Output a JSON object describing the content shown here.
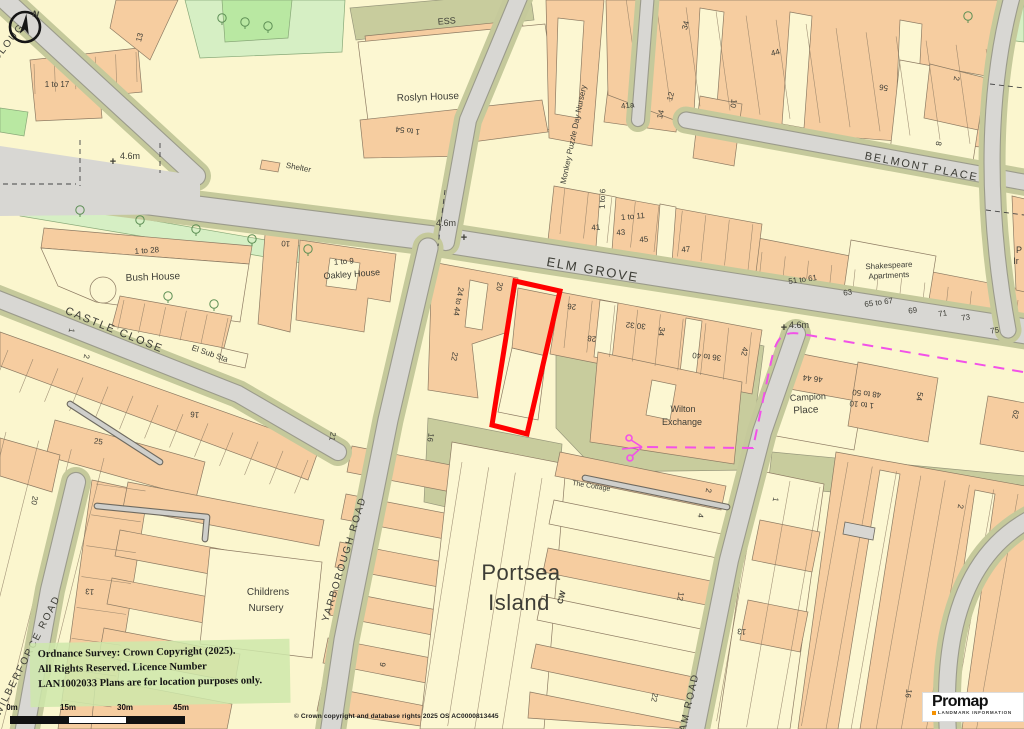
{
  "map": {
    "plot_color": "#FF0000",
    "boundary_color": "#F251E8",
    "labels": [
      {
        "t": "ELM GROVE",
        "x": 592,
        "y": 274,
        "r": 10,
        "s": 13,
        "k": "street"
      },
      {
        "t": "BELMONT PLACE",
        "x": 921,
        "y": 170,
        "r": 11,
        "s": 11,
        "k": "street"
      },
      {
        "t": "CASTLE CLOSE",
        "x": 113,
        "y": 333,
        "r": 22,
        "s": 11,
        "k": "street"
      },
      {
        "t": "YARBOROUGH ROAD",
        "x": 347,
        "y": 560,
        "r": -73,
        "s": 10,
        "k": "street"
      },
      {
        "t": "WILBERFORCE ROAD",
        "x": 30,
        "y": 657,
        "r": -63,
        "s": 10,
        "k": "street"
      },
      {
        "t": "AM ROAD",
        "x": 692,
        "y": 703,
        "r": -77,
        "s": 10,
        "k": "street"
      },
      {
        "t": "CLOUG",
        "x": 11,
        "y": 44,
        "r": -52,
        "s": 10,
        "k": "street"
      },
      {
        "t": "Roslyn House",
        "x": 428,
        "y": 100,
        "r": -2,
        "s": 10,
        "k": "name"
      },
      {
        "t": "ESS",
        "x": 447,
        "y": 24,
        "r": -5,
        "s": 9,
        "k": "name"
      },
      {
        "t": "Bush House",
        "x": 153,
        "y": 280,
        "r": -2,
        "s": 10,
        "k": "name"
      },
      {
        "t": "1 to 9",
        "x": 344,
        "y": 264,
        "r": -4,
        "s": 8,
        "k": "num"
      },
      {
        "t": "Oakley House",
        "x": 352,
        "y": 277,
        "r": -4,
        "s": 9,
        "k": "name"
      },
      {
        "t": "Shakespeare",
        "x": 889,
        "y": 268,
        "r": -3,
        "s": 8,
        "k": "name"
      },
      {
        "t": "Apartments",
        "x": 889,
        "y": 278,
        "r": -3,
        "s": 8,
        "k": "name"
      },
      {
        "t": "Wilton",
        "x": 683,
        "y": 412,
        "r": 0,
        "s": 9,
        "k": "name"
      },
      {
        "t": "Exchange",
        "x": 682,
        "y": 425,
        "r": 0,
        "s": 9,
        "k": "name"
      },
      {
        "t": "Campion",
        "x": 808,
        "y": 400,
        "r": -3,
        "s": 9,
        "k": "name"
      },
      {
        "t": "Place",
        "x": 806,
        "y": 413,
        "r": -3,
        "s": 10,
        "k": "name"
      },
      {
        "t": "Childrens",
        "x": 268,
        "y": 595,
        "r": 0,
        "s": 10,
        "k": "name"
      },
      {
        "t": "Nursery",
        "x": 266,
        "y": 611,
        "r": 0,
        "s": 10,
        "k": "name"
      },
      {
        "t": "The Cottage",
        "x": 591,
        "y": 488,
        "r": 9,
        "s": 7,
        "k": "name"
      },
      {
        "t": "Monkey Puzzle Day Nursery",
        "x": 576,
        "y": 135,
        "r": -78,
        "s": 8,
        "k": "name"
      },
      {
        "t": "Shelter",
        "x": 298,
        "y": 170,
        "r": 11,
        "s": 8,
        "k": "name"
      },
      {
        "t": "El Sub Sta",
        "x": 209,
        "y": 356,
        "r": 19,
        "s": 8,
        "k": "name"
      },
      {
        "t": "P",
        "x": 1019,
        "y": 253,
        "r": 0,
        "s": 9,
        "k": "name"
      },
      {
        "t": "Ir",
        "x": 1016,
        "y": 264,
        "r": 0,
        "s": 9,
        "k": "name"
      },
      {
        "t": "Portsea",
        "x": 521,
        "y": 580,
        "r": 0,
        "s": 22,
        "k": "big"
      },
      {
        "t": "Island",
        "x": 519,
        "y": 610,
        "r": 0,
        "s": 22,
        "k": "big"
      },
      {
        "t": "CW",
        "x": 564,
        "y": 598,
        "r": -75,
        "s": 8,
        "k": "mag"
      },
      {
        "t": "13",
        "x": 142,
        "y": 38,
        "r": -75,
        "s": 8,
        "k": "num"
      },
      {
        "t": "1 to 17",
        "x": 57,
        "y": 87,
        "r": 0,
        "s": 8,
        "k": "num"
      },
      {
        "t": "1 to 54",
        "x": 408,
        "y": 128,
        "r": 187,
        "s": 8,
        "k": "num"
      },
      {
        "t": "1 to 28",
        "x": 147,
        "y": 253,
        "r": -4,
        "s": 8,
        "k": "num"
      },
      {
        "t": "41a",
        "x": 628,
        "y": 108,
        "r": -8,
        "s": 8,
        "k": "num"
      },
      {
        "t": "14",
        "x": 663,
        "y": 115,
        "r": -75,
        "s": 8,
        "k": "num"
      },
      {
        "t": "12",
        "x": 673,
        "y": 97,
        "r": -75,
        "s": 8,
        "k": "num"
      },
      {
        "t": "34",
        "x": 688,
        "y": 26,
        "r": -75,
        "s": 8,
        "k": "num"
      },
      {
        "t": "44",
        "x": 776,
        "y": 55,
        "r": -15,
        "s": 8,
        "k": "num"
      },
      {
        "t": "10",
        "x": 731,
        "y": 103,
        "r": 100,
        "s": 8,
        "k": "num"
      },
      {
        "t": "56",
        "x": 884,
        "y": 85,
        "r": 188,
        "s": 8,
        "k": "num"
      },
      {
        "t": "2",
        "x": 954,
        "y": 78,
        "r": 100,
        "s": 8,
        "k": "num"
      },
      {
        "t": "8",
        "x": 936,
        "y": 143,
        "r": 100,
        "s": 8,
        "k": "num"
      },
      {
        "t": "10",
        "x": 286,
        "y": 241,
        "r": 185,
        "s": 8,
        "k": "num"
      },
      {
        "t": "1 to 6",
        "x": 605,
        "y": 199,
        "r": -88,
        "s": 8,
        "k": "num"
      },
      {
        "t": "41",
        "x": 596,
        "y": 230,
        "r": -5,
        "s": 8,
        "k": "num"
      },
      {
        "t": "1 to 11",
        "x": 633,
        "y": 219,
        "r": -5,
        "s": 8,
        "k": "num"
      },
      {
        "t": "43",
        "x": 621,
        "y": 235,
        "r": -5,
        "s": 8,
        "k": "num"
      },
      {
        "t": "45",
        "x": 644,
        "y": 242,
        "r": -5,
        "s": 8,
        "k": "num"
      },
      {
        "t": "47",
        "x": 686,
        "y": 252,
        "r": -5,
        "s": 8,
        "k": "num"
      },
      {
        "t": "51 to 61",
        "x": 803,
        "y": 282,
        "r": -8,
        "s": 8,
        "k": "num"
      },
      {
        "t": "63",
        "x": 848,
        "y": 295,
        "r": -8,
        "s": 8,
        "k": "num"
      },
      {
        "t": "65 to 67",
        "x": 879,
        "y": 305,
        "r": -8,
        "s": 8,
        "k": "num"
      },
      {
        "t": "69",
        "x": 913,
        "y": 313,
        "r": -8,
        "s": 8,
        "k": "num"
      },
      {
        "t": "71",
        "x": 943,
        "y": 316,
        "r": -8,
        "s": 8,
        "k": "num"
      },
      {
        "t": "73",
        "x": 966,
        "y": 320,
        "r": -8,
        "s": 8,
        "k": "num"
      },
      {
        "t": "75",
        "x": 995,
        "y": 333,
        "r": -8,
        "s": 8,
        "k": "num"
      },
      {
        "t": "24 to 44",
        "x": 456,
        "y": 301,
        "r": 100,
        "s": 8,
        "k": "num"
      },
      {
        "t": "20",
        "x": 497,
        "y": 286,
        "r": 100,
        "s": 8,
        "k": "num"
      },
      {
        "t": "22",
        "x": 452,
        "y": 356,
        "r": 100,
        "s": 8,
        "k": "num"
      },
      {
        "t": "26",
        "x": 572,
        "y": 304,
        "r": 186,
        "s": 8,
        "k": "num"
      },
      {
        "t": "28",
        "x": 592,
        "y": 336,
        "r": 186,
        "s": 8,
        "k": "num"
      },
      {
        "t": "30 32",
        "x": 636,
        "y": 323,
        "r": 186,
        "s": 8,
        "k": "num"
      },
      {
        "t": "34",
        "x": 659,
        "y": 331,
        "r": 100,
        "s": 8,
        "k": "num"
      },
      {
        "t": "36 to 40",
        "x": 707,
        "y": 354,
        "r": 186,
        "s": 8,
        "k": "num"
      },
      {
        "t": "42",
        "x": 742,
        "y": 351,
        "r": 100,
        "s": 8,
        "k": "num"
      },
      {
        "t": "46 44",
        "x": 813,
        "y": 376,
        "r": 186,
        "s": 8,
        "k": "num"
      },
      {
        "t": "48 to 50",
        "x": 867,
        "y": 391,
        "r": 186,
        "s": 8,
        "k": "num"
      },
      {
        "t": "1 to 10",
        "x": 862,
        "y": 402,
        "r": 186,
        "s": 8,
        "k": "num"
      },
      {
        "t": "54",
        "x": 917,
        "y": 396,
        "r": 100,
        "s": 8,
        "k": "num"
      },
      {
        "t": "62",
        "x": 1013,
        "y": 414,
        "r": 100,
        "s": 8,
        "k": "num"
      },
      {
        "t": "1",
        "x": 773,
        "y": 499,
        "r": 100,
        "s": 8,
        "k": "num"
      },
      {
        "t": "2",
        "x": 958,
        "y": 506,
        "r": 100,
        "s": 8,
        "k": "num"
      },
      {
        "t": "2",
        "x": 706,
        "y": 490,
        "r": 100,
        "s": 8,
        "k": "num"
      },
      {
        "t": "4",
        "x": 698,
        "y": 515,
        "r": 100,
        "s": 8,
        "k": "num"
      },
      {
        "t": "12",
        "x": 678,
        "y": 596,
        "r": 100,
        "s": 8,
        "k": "num"
      },
      {
        "t": "13",
        "x": 742,
        "y": 629,
        "r": 186,
        "s": 8,
        "k": "num"
      },
      {
        "t": "22",
        "x": 652,
        "y": 697,
        "r": 100,
        "s": 8,
        "k": "num"
      },
      {
        "t": "16",
        "x": 906,
        "y": 693,
        "r": 100,
        "s": 8,
        "k": "num"
      },
      {
        "t": "9",
        "x": 380,
        "y": 664,
        "r": 100,
        "s": 8,
        "k": "num"
      },
      {
        "t": "16",
        "x": 428,
        "y": 437,
        "r": 100,
        "s": 8,
        "k": "num"
      },
      {
        "t": "16",
        "x": 195,
        "y": 412,
        "r": 186,
        "s": 8,
        "k": "num"
      },
      {
        "t": "25",
        "x": 98,
        "y": 444,
        "r": 8,
        "s": 8,
        "k": "num"
      },
      {
        "t": "20",
        "x": 32,
        "y": 500,
        "r": 100,
        "s": 8,
        "k": "num"
      },
      {
        "t": "13",
        "x": 90,
        "y": 589,
        "r": 186,
        "s": 8,
        "k": "num"
      },
      {
        "t": "21",
        "x": 330,
        "y": 436,
        "r": 100,
        "s": 8,
        "k": "num"
      },
      {
        "t": "1",
        "x": 69,
        "y": 330,
        "r": 100,
        "s": 8,
        "k": "num"
      },
      {
        "t": "2",
        "x": 84,
        "y": 356,
        "r": 100,
        "s": 8,
        "k": "num"
      },
      {
        "t": "4.6m",
        "x": 130,
        "y": 159,
        "r": 0,
        "s": 9,
        "k": "spot"
      },
      {
        "t": "+",
        "x": 113,
        "y": 165,
        "r": 0,
        "s": 11,
        "k": "cross"
      },
      {
        "t": "4.6m",
        "x": 446,
        "y": 226,
        "r": 0,
        "s": 9,
        "k": "spot"
      },
      {
        "t": "+",
        "x": 464,
        "y": 241,
        "r": 0,
        "s": 11,
        "k": "cross"
      },
      {
        "t": "4.6m",
        "x": 799,
        "y": 328,
        "r": 0,
        "s": 9,
        "k": "spot"
      },
      {
        "t": "+",
        "x": 784,
        "y": 331,
        "r": 0,
        "s": 11,
        "k": "cross"
      }
    ]
  },
  "compass": {
    "north": "N"
  },
  "overlay": {
    "license_lines": [
      "Ordnance Survey: Crown Copyright (2025).",
      "All Rights Reserved. Licence Number",
      "LAN1002033 Plans are for location purposes only."
    ],
    "os_credit": "© Crown copyright and database rights 2025 OS AC0000813445",
    "scale_labels": [
      "0m",
      "15m",
      "30m",
      "45m"
    ]
  },
  "logo": {
    "brand": "Promap",
    "tagline": "LANDMARK INFORMATION"
  }
}
